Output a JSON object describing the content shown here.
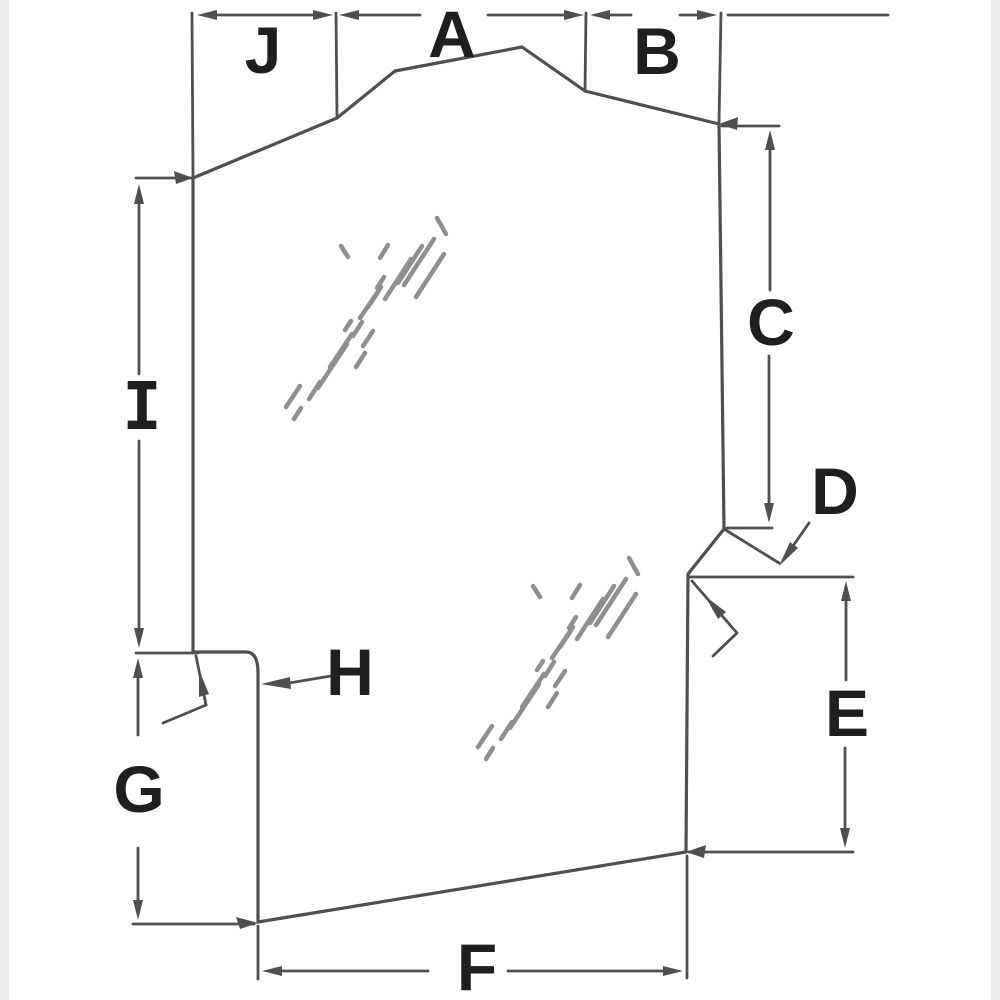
{
  "diagram": {
    "type": "glass-panel-dimension-diagram",
    "labels": {
      "a": "A",
      "b": "B",
      "c": "C",
      "d": "D",
      "e": "E",
      "f": "F",
      "g": "G",
      "h": "H",
      "i": "I",
      "j": "J"
    }
  },
  "colors": {
    "line": "#4f4f4f",
    "hatch": "#8f8f8f",
    "label": "#1f1f1f",
    "background": "#ffffff"
  }
}
